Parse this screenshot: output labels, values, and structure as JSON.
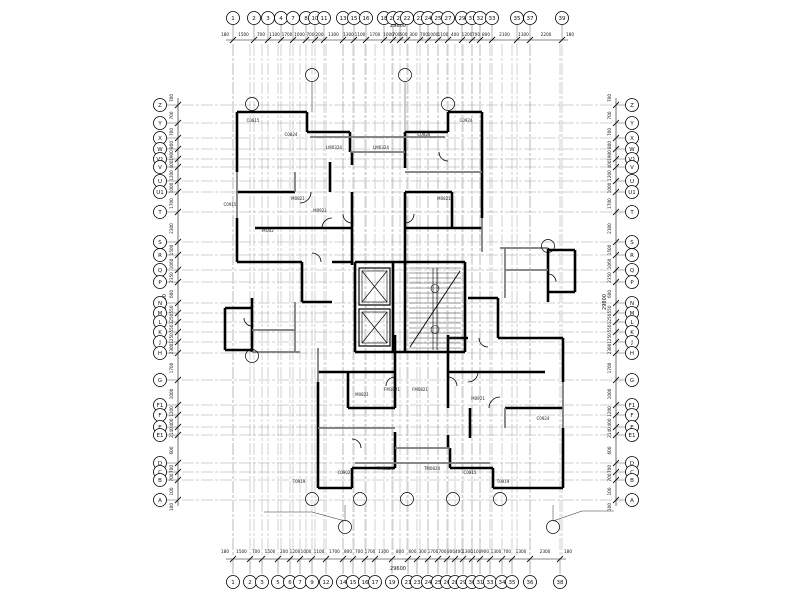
{
  "colors": {
    "wall": "#000000",
    "lite_wall": "#787878",
    "grid": "#9b9b9b",
    "dim": "#111111",
    "paper": "#ffffff"
  },
  "axes": {
    "top": {
      "labels": [
        "1",
        "2",
        "3",
        "4",
        "7",
        "8",
        "10",
        "11",
        "13",
        "15",
        "16",
        "18",
        "20",
        "21",
        "22",
        "23",
        "24",
        "25",
        "27",
        "29",
        "31",
        "32",
        "33",
        "35",
        "37",
        "39"
      ],
      "x": [
        233,
        254,
        268,
        281,
        293,
        306,
        315,
        324,
        343,
        354,
        366,
        384,
        393,
        400,
        407,
        420,
        428,
        438,
        448,
        462,
        472,
        480,
        492,
        517,
        530,
        562
      ],
      "dims": [
        "1500",
        "700",
        "1100",
        "1700",
        "1000",
        "700",
        "200",
        "1300",
        "1300",
        "1100",
        "1700",
        "1000",
        "700",
        "600",
        "300",
        "700",
        "1000",
        "1100",
        "400",
        "1200",
        "700",
        "800",
        "2100",
        "1300",
        "2200"
      ],
      "end_left": "180",
      "end_right": "180",
      "total": "29600"
    },
    "bottom": {
      "labels": [
        "1",
        "2",
        "3",
        "5",
        "6",
        "7",
        "9",
        "12",
        "14",
        "15",
        "16",
        "17",
        "19",
        "21",
        "23",
        "24",
        "25",
        "26",
        "28",
        "29",
        "30",
        "31",
        "33",
        "34",
        "35",
        "36",
        "38"
      ],
      "x": [
        233,
        250,
        262,
        278,
        290,
        300,
        312,
        326,
        343,
        353,
        365,
        375,
        392,
        408,
        417,
        428,
        438,
        447,
        455,
        463,
        472,
        480,
        490,
        502,
        512,
        530,
        560
      ],
      "dims": [
        "1500",
        "700",
        "1500",
        "200",
        "1200",
        "1000",
        "1100",
        "1700",
        "800",
        "700",
        "1700",
        "1300",
        "800",
        "600",
        "300",
        "1700",
        "700",
        "800",
        "400",
        "1300",
        "1100",
        "900",
        "1300",
        "700",
        "1300",
        "2300"
      ],
      "end_left": "180",
      "end_right": "180",
      "total": "29600"
    },
    "left": {
      "labels": [
        "Z",
        "Y",
        "X",
        "W",
        "V1",
        "V",
        "U",
        "U1",
        "T",
        "S",
        "R",
        "Q",
        "P",
        "N",
        "M",
        "L",
        "K",
        "J",
        "H",
        "G",
        "F1",
        "F",
        "E",
        "E1",
        "D",
        "C",
        "B",
        "A"
      ],
      "y": [
        105,
        123,
        138,
        149,
        159,
        167,
        181,
        192,
        212,
        242,
        255,
        270,
        282,
        303,
        313,
        322,
        332,
        342,
        353,
        380,
        405,
        415,
        427,
        435,
        463,
        472,
        480,
        500
      ],
      "dims": [
        "700",
        "700",
        "800",
        "1900",
        "400",
        "1200",
        "1000",
        "1700",
        "2300",
        "1500",
        "1060",
        "2350",
        "600",
        "550",
        "1250",
        "550",
        "1250",
        "2300",
        "1700",
        "1000",
        "1200",
        "400",
        "2140",
        "600",
        "700",
        "700",
        "100"
      ],
      "end_top": "700",
      "end_bottom": "100",
      "total": "29800"
    },
    "right": {
      "labels": [
        "Z",
        "Y",
        "X",
        "W",
        "V1",
        "V",
        "U",
        "U1",
        "T",
        "S",
        "R",
        "Q",
        "P",
        "N",
        "M",
        "L",
        "K",
        "J",
        "H",
        "G",
        "F1",
        "F",
        "E",
        "E1",
        "D",
        "C",
        "B",
        "A"
      ],
      "y": [
        105,
        123,
        138,
        149,
        159,
        167,
        181,
        192,
        212,
        242,
        255,
        270,
        282,
        303,
        313,
        322,
        332,
        342,
        353,
        380,
        405,
        415,
        427,
        435,
        463,
        472,
        480,
        500
      ],
      "dims": [
        "700",
        "700",
        "800",
        "1900",
        "400",
        "1200",
        "1000",
        "1700",
        "2300",
        "1500",
        "1060",
        "2350",
        "600",
        "550",
        "1250",
        "550",
        "1250",
        "2300",
        "1700",
        "1000",
        "1200",
        "400",
        "2140",
        "600",
        "700",
        "700",
        "100"
      ],
      "end_top": "700",
      "end_bottom": "100",
      "total": "29800"
    }
  },
  "plan": {
    "walls_unit": [
      [
        237,
        112,
        307,
        112
      ],
      [
        237,
        112,
        237,
        172
      ],
      [
        307,
        112,
        307,
        132
      ],
      [
        307,
        132,
        350,
        132
      ],
      [
        350,
        132,
        350,
        152
      ],
      [
        405,
        132,
        405,
        152
      ],
      [
        405,
        132,
        448,
        132
      ],
      [
        448,
        112,
        448,
        132
      ],
      [
        448,
        112,
        482,
        112
      ],
      [
        482,
        112,
        482,
        218
      ],
      [
        237,
        218,
        237,
        262
      ],
      [
        237,
        192,
        295,
        192
      ],
      [
        330,
        162,
        330,
        192
      ],
      [
        255,
        228,
        352,
        228
      ],
      [
        352,
        192,
        352,
        265
      ],
      [
        405,
        192,
        405,
        265
      ],
      [
        405,
        192,
        452,
        192
      ],
      [
        452,
        192,
        452,
        228
      ],
      [
        405,
        228,
        482,
        228
      ],
      [
        237,
        262,
        302,
        262
      ],
      [
        302,
        262,
        302,
        302
      ],
      [
        302,
        302,
        332,
        302
      ],
      [
        225,
        308,
        252,
        308
      ],
      [
        225,
        308,
        225,
        350
      ],
      [
        225,
        350,
        252,
        350
      ],
      [
        252,
        298,
        252,
        352
      ],
      [
        352,
        152,
        352,
        165
      ],
      [
        405,
        152,
        405,
        168
      ],
      [
        332,
        262,
        352,
        262
      ]
    ],
    "lite_unit": [
      [
        350,
        152,
        405,
        152
      ],
      [
        310,
        137,
        445,
        137
      ],
      [
        237,
        172,
        237,
        218
      ],
      [
        482,
        218,
        482,
        252
      ],
      [
        295,
        172,
        295,
        192
      ],
      [
        252,
        330,
        295,
        330
      ],
      [
        405,
        172,
        482,
        172
      ],
      [
        295,
        302,
        295,
        352
      ],
      [
        252,
        352,
        300,
        352
      ]
    ],
    "arcs_unit": [
      [
        300,
        192,
        11,
        0,
        90
      ],
      [
        332,
        228,
        10,
        180,
        270
      ],
      [
        352,
        214,
        9,
        90,
        180
      ],
      [
        405,
        214,
        9,
        0,
        90
      ],
      [
        312,
        262,
        9,
        270,
        360
      ],
      [
        252,
        318,
        8,
        90,
        180
      ],
      [
        448,
        152,
        9,
        90,
        180
      ]
    ],
    "core": {
      "walls": [
        [
          355,
          262,
          465,
          262
        ],
        [
          355,
          262,
          355,
          352
        ],
        [
          465,
          262,
          465,
          352
        ],
        [
          355,
          352,
          465,
          352
        ],
        [
          393,
          262,
          393,
          352
        ],
        [
          405,
          262,
          405,
          352
        ]
      ],
      "elevators": [
        [
          359,
          268,
          31,
          37
        ],
        [
          359,
          309,
          31,
          37
        ]
      ],
      "stair": {
        "x": 408,
        "y": 268,
        "w": 54,
        "h": 82,
        "step": 5
      }
    },
    "markers": [
      [
        312,
        75
      ],
      [
        405,
        75
      ],
      [
        252,
        104
      ],
      [
        448,
        104
      ],
      [
        548,
        246
      ],
      [
        252,
        356
      ],
      [
        312,
        499
      ],
      [
        360,
        499
      ],
      [
        407,
        499
      ],
      [
        453,
        499
      ],
      [
        500,
        499
      ],
      [
        345,
        527
      ],
      [
        553,
        527
      ]
    ],
    "connectors": [
      [
        312,
        82,
        312,
        112
      ],
      [
        405,
        82,
        405,
        132
      ],
      [
        345,
        520,
        345,
        505
      ],
      [
        553,
        520,
        553,
        505
      ]
    ],
    "leaders": [
      [
        [
          345,
          521
        ],
        [
          312,
          512
        ],
        [
          264,
          512
        ]
      ],
      [
        [
          553,
          521
        ],
        [
          582,
          511
        ],
        [
          614,
          511
        ]
      ]
    ],
    "mark_labels": [
      [
        "C0815",
        253,
        122
      ],
      [
        "C0824",
        291,
        136
      ],
      [
        "LM0324",
        334,
        149
      ],
      [
        "LM0324",
        381,
        149
      ],
      [
        "C0824",
        424,
        136
      ],
      [
        "C0924",
        466,
        122
      ],
      [
        "M0821",
        298,
        200
      ],
      [
        "M0921",
        320,
        212
      ],
      [
        "MQ02",
        268,
        232
      ],
      [
        "M0821",
        444,
        200
      ],
      [
        "C0915",
        230,
        206
      ],
      [
        "FM1021",
        392,
        391
      ],
      [
        "FM0821",
        420,
        391
      ],
      [
        "M0821",
        362,
        396
      ],
      [
        "M0921",
        478,
        400
      ],
      [
        "TM0824",
        385,
        470
      ],
      [
        "TM0824",
        432,
        470
      ],
      [
        "C0902",
        344,
        474
      ],
      [
        "C0815",
        470,
        474
      ],
      [
        "T0919",
        299,
        483
      ],
      [
        "T0919",
        503,
        483
      ],
      [
        "C0924",
        543,
        420
      ]
    ]
  }
}
